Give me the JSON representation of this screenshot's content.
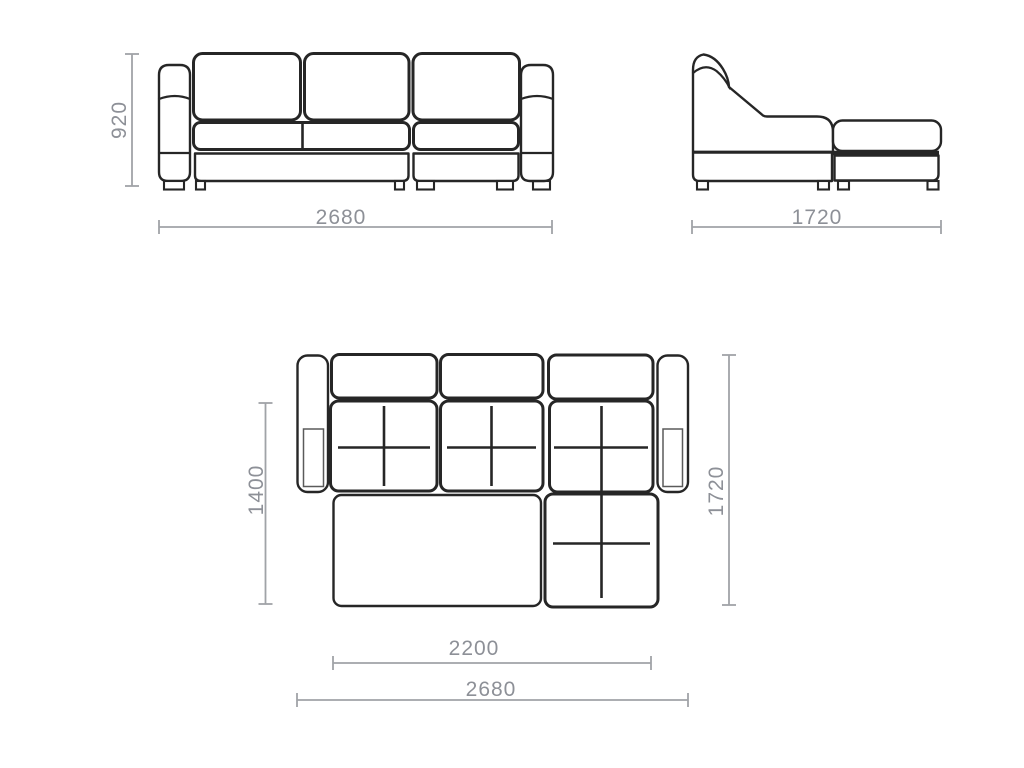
{
  "colors": {
    "background": "#ffffff",
    "outline": "#262626",
    "dimension_line": "#a0a3a7",
    "dimension_text": "#8d9097",
    "armrest_inset": "#5a5a5a"
  },
  "front_view": {
    "height_label": "920",
    "width_label": "2680"
  },
  "side_view": {
    "depth_label": "1720"
  },
  "top_view": {
    "bed_depth_label": "1400",
    "depth_label": "1720",
    "bed_length_label": "2200",
    "width_label": "2680"
  }
}
